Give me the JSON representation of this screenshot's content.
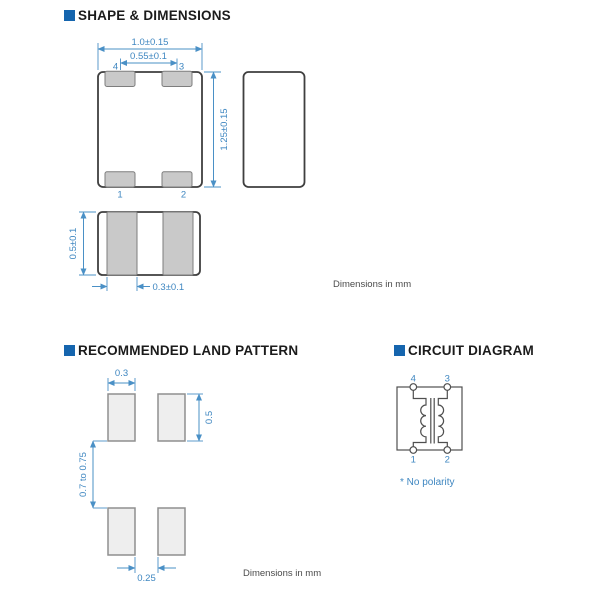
{
  "colors": {
    "accent": "#1565ae",
    "dim_blue": "#4a90c6"
  },
  "sections": {
    "shape": {
      "title": "SHAPE & DIMENSIONS",
      "note": "Dimensions in mm",
      "top_view": {
        "dim_body_width": "1.0±0.15",
        "dim_terminal_pitch": "0.55±0.1",
        "dim_body_length": "1.25±0.15",
        "pin_top_left": "4",
        "pin_top_right": "3",
        "pin_bottom_left": "1",
        "pin_bottom_right": "2"
      },
      "front_view": {
        "dim_body_height": "0.5±0.1",
        "dim_terminal_width": "0.3±0.1"
      }
    },
    "land_pattern": {
      "title": "RECOMMENDED LAND PATTERN",
      "note": "Dimensions in mm",
      "dim_pad_width": "0.3",
      "dim_pad_height": "0.5",
      "dim_row_gap": "0.7 to 0.75",
      "dim_pad_gap": "0.25"
    },
    "circuit": {
      "title": "CIRCUIT DIAGRAM",
      "note": "* No polarity",
      "pin_top_left": "4",
      "pin_top_right": "3",
      "pin_bottom_left": "1",
      "pin_bottom_right": "2"
    }
  }
}
